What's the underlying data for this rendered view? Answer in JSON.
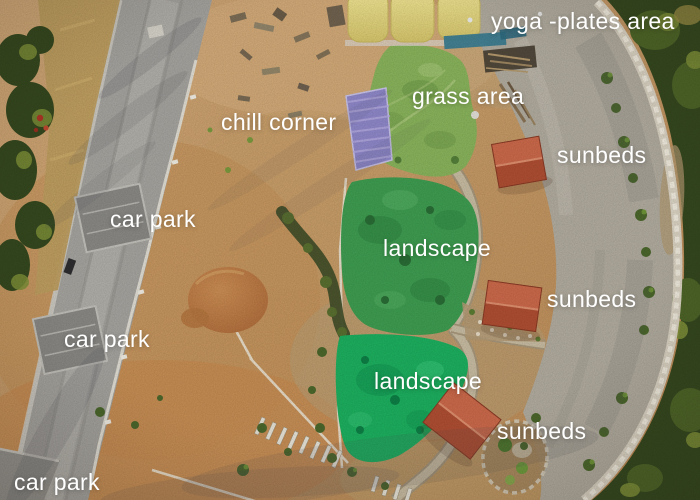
{
  "scene": {
    "description": "Aerial drone photo of a hillside resort property at golden hour, annotated with white area labels"
  },
  "labels": {
    "yoga_plates": "yoga -plates area",
    "grass": "grass area",
    "chill": "chill corner",
    "car_park_1": "car park",
    "car_park_2": "car park",
    "car_park_3": "car park",
    "sunbeds_1": "sunbeds",
    "sunbeds_2": "sunbeds",
    "sunbeds_3": "sunbeds",
    "landscape_1": "landscape",
    "landscape_2": "landscape"
  },
  "colors": {
    "label-text": "#ffffff",
    "dirt-base": "#c69a66",
    "dirt-light": "#d4ab7a",
    "dirt-orange": "#c98a4e",
    "road-gray": "#a7a5a0",
    "road-shoulder": "#e9e5da",
    "gravel": "#b3ada0",
    "stone-wall": "#ddd6c6",
    "tree-dark": "#35491f",
    "tree-mid": "#4e6628",
    "tree-light": "#7e9138",
    "golden-grass": "#bf9f60",
    "tent-yellow": "#ecdf8c",
    "grass-area-green": "#8ab55c",
    "landscape-green-1": "#3f9e51",
    "landscape-green-2": "#1db160",
    "tarp-purple": "#9089cb",
    "sunbed-roof": "#cd6a4b",
    "sunbed-roof-dark": "#b04f33",
    "path-tan": "#c9bda3",
    "pipe-white": "#ece5d4",
    "pad-gray": "#8b8a86",
    "mound-brown": "#b06c3a"
  }
}
